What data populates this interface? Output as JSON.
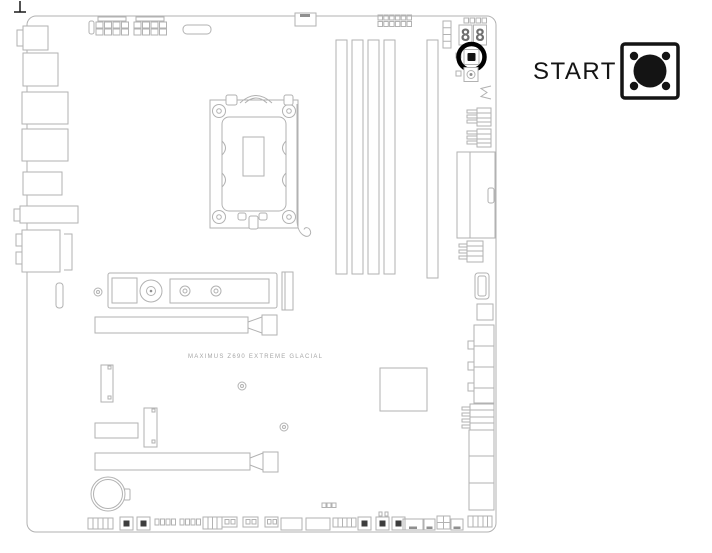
{
  "board": {
    "label": "MAXIMUS Z690 EXTREME GLACIAL",
    "debug_display": {
      "digits": [
        "8",
        "8"
      ]
    }
  },
  "callout": {
    "label": "START",
    "icon": "start-power-button-icon"
  },
  "colors": {
    "line": "#b2b2b2",
    "display_digit": "#6f6f6f",
    "highlight": "#000000",
    "button_fill": "#141414"
  }
}
